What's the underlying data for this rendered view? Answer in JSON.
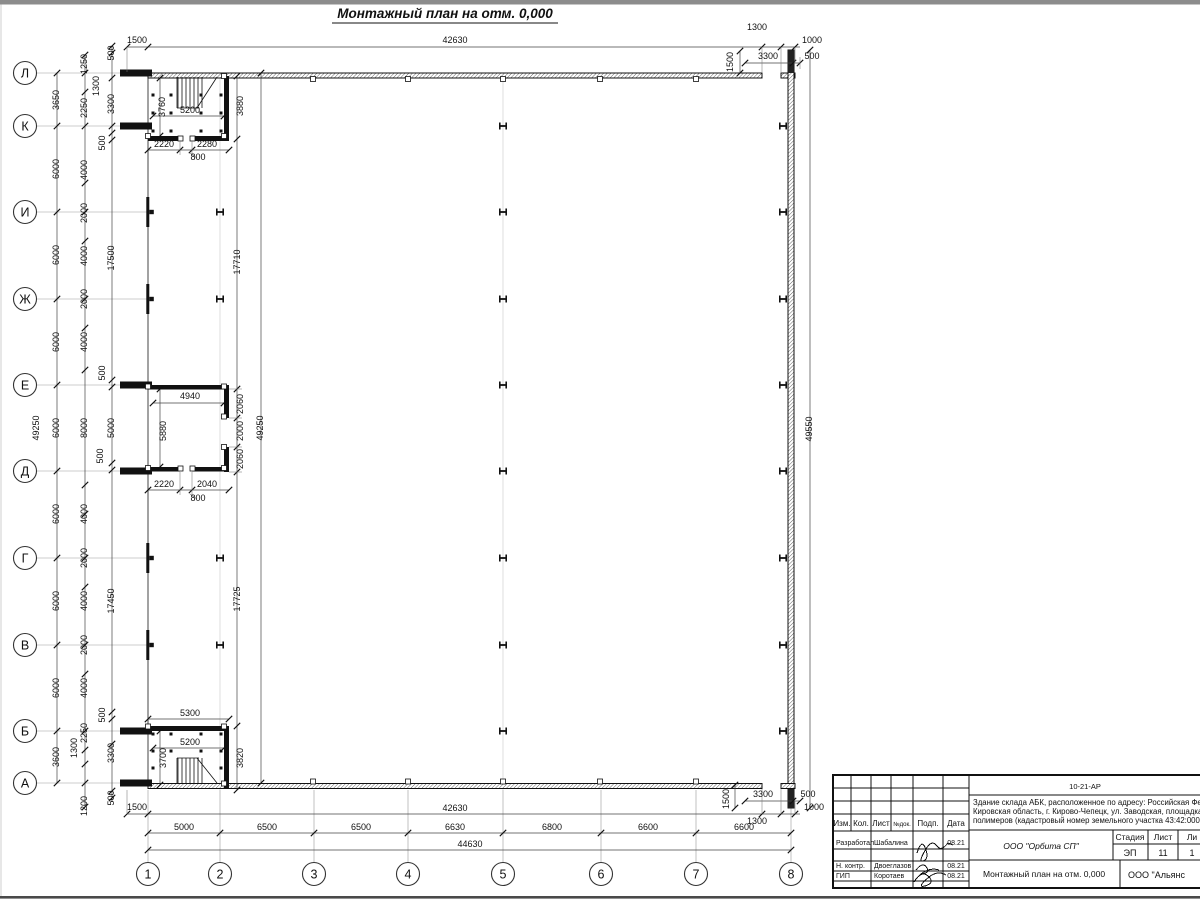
{
  "sheet": {
    "title": "Монтажный план на отм. 0,000"
  },
  "axes": {
    "left": [
      {
        "label": "Л",
        "y": 73
      },
      {
        "label": "К",
        "y": 126
      },
      {
        "label": "И",
        "y": 212
      },
      {
        "label": "Ж",
        "y": 299
      },
      {
        "label": "Е",
        "y": 385
      },
      {
        "label": "Д",
        "y": 471
      },
      {
        "label": "Г",
        "y": 558
      },
      {
        "label": "В",
        "y": 645
      },
      {
        "label": "Б",
        "y": 731
      },
      {
        "label": "А",
        "y": 783
      }
    ],
    "bottom": [
      {
        "label": "1",
        "x": 148
      },
      {
        "label": "2",
        "x": 220
      },
      {
        "label": "3",
        "x": 314
      },
      {
        "label": "4",
        "x": 408
      },
      {
        "label": "5",
        "x": 503
      },
      {
        "label": "6",
        "x": 601
      },
      {
        "label": "7",
        "x": 696
      },
      {
        "label": "8",
        "x": 791
      }
    ]
  },
  "dimensions": [
    {
      "text": "1500",
      "x": 137,
      "y": 43
    },
    {
      "text": "42630",
      "x": 455,
      "y": 43
    },
    {
      "text": "1300",
      "x": 757,
      "y": 30
    },
    {
      "text": "1000",
      "x": 812,
      "y": 43
    },
    {
      "text": "1500",
      "x": 733,
      "y": 62,
      "rot": -90
    },
    {
      "text": "3300",
      "x": 768,
      "y": 59
    },
    {
      "text": "500",
      "x": 812,
      "y": 59
    },
    {
      "text": "49250",
      "x": 39,
      "y": 428,
      "rot": -90
    },
    {
      "text": "3650",
      "x": 59,
      "y": 100,
      "rot": -90
    },
    {
      "text": "6000",
      "x": 59,
      "y": 169,
      "rot": -90
    },
    {
      "text": "6000",
      "x": 59,
      "y": 255,
      "rot": -90
    },
    {
      "text": "6000",
      "x": 59,
      "y": 342,
      "rot": -90
    },
    {
      "text": "6000",
      "x": 59,
      "y": 428,
      "rot": -90
    },
    {
      "text": "6000",
      "x": 59,
      "y": 514,
      "rot": -90
    },
    {
      "text": "6000",
      "x": 59,
      "y": 601,
      "rot": -90
    },
    {
      "text": "6000",
      "x": 59,
      "y": 688,
      "rot": -90
    },
    {
      "text": "3600",
      "x": 59,
      "y": 757,
      "rot": -90
    },
    {
      "text": "1250",
      "x": 87,
      "y": 64,
      "rot": -90
    },
    {
      "text": "1300",
      "x": 99,
      "y": 86,
      "rot": -90
    },
    {
      "text": "2250",
      "x": 87,
      "y": 108,
      "rot": -90
    },
    {
      "text": "4000",
      "x": 87,
      "y": 170,
      "rot": -90
    },
    {
      "text": "2000",
      "x": 87,
      "y": 213,
      "rot": -90
    },
    {
      "text": "4000",
      "x": 87,
      "y": 256,
      "rot": -90
    },
    {
      "text": "2000",
      "x": 87,
      "y": 299,
      "rot": -90
    },
    {
      "text": "4000",
      "x": 87,
      "y": 342,
      "rot": -90
    },
    {
      "text": "8000",
      "x": 87,
      "y": 428,
      "rot": -90
    },
    {
      "text": "4000",
      "x": 87,
      "y": 514,
      "rot": -90
    },
    {
      "text": "2000",
      "x": 87,
      "y": 558,
      "rot": -90
    },
    {
      "text": "4000",
      "x": 87,
      "y": 601,
      "rot": -90
    },
    {
      "text": "2000",
      "x": 87,
      "y": 645,
      "rot": -90
    },
    {
      "text": "4000",
      "x": 87,
      "y": 688,
      "rot": -90
    },
    {
      "text": "2250",
      "x": 87,
      "y": 733,
      "rot": -90
    },
    {
      "text": "1300",
      "x": 77,
      "y": 748,
      "rot": -90
    },
    {
      "text": "1200",
      "x": 87,
      "y": 806,
      "rot": -90
    },
    {
      "text": "500",
      "x": 114,
      "y": 53,
      "rot": -90
    },
    {
      "text": "3300",
      "x": 114,
      "y": 104,
      "rot": -90
    },
    {
      "text": "500",
      "x": 105,
      "y": 143,
      "rot": -90
    },
    {
      "text": "17500",
      "x": 114,
      "y": 258,
      "rot": -90
    },
    {
      "text": "500",
      "x": 105,
      "y": 373,
      "rot": -90
    },
    {
      "text": "5000",
      "x": 114,
      "y": 428,
      "rot": -90
    },
    {
      "text": "500",
      "x": 103,
      "y": 456,
      "rot": -90
    },
    {
      "text": "17450",
      "x": 114,
      "y": 601,
      "rot": -90
    },
    {
      "text": "500",
      "x": 105,
      "y": 715,
      "rot": -90
    },
    {
      "text": "3300",
      "x": 114,
      "y": 753,
      "rot": -90
    },
    {
      "text": "500",
      "x": 114,
      "y": 798,
      "rot": -90
    },
    {
      "text": "17710",
      "x": 240,
      "y": 262,
      "rot": -90
    },
    {
      "text": "17725",
      "x": 240,
      "y": 599,
      "rot": -90
    },
    {
      "text": "49250",
      "x": 263,
      "y": 428,
      "rot": -90
    },
    {
      "text": "49550",
      "x": 812,
      "y": 429,
      "rot": -90
    },
    {
      "text": "3760",
      "x": 165,
      "y": 107,
      "rot": -90
    },
    {
      "text": "5200",
      "x": 190,
      "y": 113
    },
    {
      "text": "3880",
      "x": 243,
      "y": 106,
      "rot": -90
    },
    {
      "text": "2220",
      "x": 164,
      "y": 147
    },
    {
      "text": "2280",
      "x": 207,
      "y": 147
    },
    {
      "text": "800",
      "x": 198,
      "y": 160
    },
    {
      "text": "4940",
      "x": 190,
      "y": 399
    },
    {
      "text": "5880",
      "x": 166,
      "y": 431,
      "rot": -90
    },
    {
      "text": "2060",
      "x": 243,
      "y": 404,
      "rot": -90
    },
    {
      "text": "2000",
      "x": 243,
      "y": 431,
      "rot": -90
    },
    {
      "text": "2060",
      "x": 243,
      "y": 459,
      "rot": -90
    },
    {
      "text": "2220",
      "x": 164,
      "y": 487
    },
    {
      "text": "2040",
      "x": 207,
      "y": 487
    },
    {
      "text": "800",
      "x": 198,
      "y": 501
    },
    {
      "text": "5300",
      "x": 190,
      "y": 716
    },
    {
      "text": "5200",
      "x": 190,
      "y": 745
    },
    {
      "text": "3700",
      "x": 166,
      "y": 758,
      "rot": -90
    },
    {
      "text": "3820",
      "x": 243,
      "y": 758,
      "rot": -90
    },
    {
      "text": "1500",
      "x": 137,
      "y": 810
    },
    {
      "text": "42630",
      "x": 455,
      "y": 811
    },
    {
      "text": "3300",
      "x": 763,
      "y": 797
    },
    {
      "text": "500",
      "x": 808,
      "y": 797
    },
    {
      "text": "1000",
      "x": 814,
      "y": 810
    },
    {
      "text": "1300",
      "x": 757,
      "y": 824
    },
    {
      "text": "1500",
      "x": 729,
      "y": 799,
      "rot": -90
    },
    {
      "text": "5000",
      "x": 184,
      "y": 830
    },
    {
      "text": "6500",
      "x": 267,
      "y": 830
    },
    {
      "text": "6500",
      "x": 361,
      "y": 830
    },
    {
      "text": "6630",
      "x": 455,
      "y": 830
    },
    {
      "text": "6800",
      "x": 552,
      "y": 830
    },
    {
      "text": "6600",
      "x": 648,
      "y": 830
    },
    {
      "text": "6600",
      "x": 744,
      "y": 830
    },
    {
      "text": "44630",
      "x": 470,
      "y": 847
    }
  ],
  "title_block": {
    "doc_number": "10-21-АР",
    "description_lines": [
      "Здание склада АБК, расположенное по адресу: Российская Феде",
      "Кировская область, г. Кирово-Чепецк, ул. Заводская, площадка з",
      "полимеров (кадастровый номер земельного участка 43:42:0000"
    ],
    "header_cols": [
      "Изм.",
      "Кол.",
      "Лист",
      "№док.",
      "Подп.",
      "Дата"
    ],
    "rows": [
      {
        "role": "Разработал",
        "name": "Шабалина",
        "date": "08.21"
      },
      {
        "role": "Н. контр.",
        "name": "Двоеглазов",
        "date": "08.21"
      },
      {
        "role": "ГИП",
        "name": "Коротаев",
        "date": "08.21"
      }
    ],
    "company": "ООО \"Орбита СП\"",
    "stage_label": "Стадия",
    "sheet_label": "Лист",
    "sheets_label": "Ли",
    "stage": "ЭП",
    "sheet_no": "11",
    "sheets_no": "1",
    "drawing_title": "Монтажный план на отм. 0,000",
    "org": "ООО \"Альянс"
  }
}
